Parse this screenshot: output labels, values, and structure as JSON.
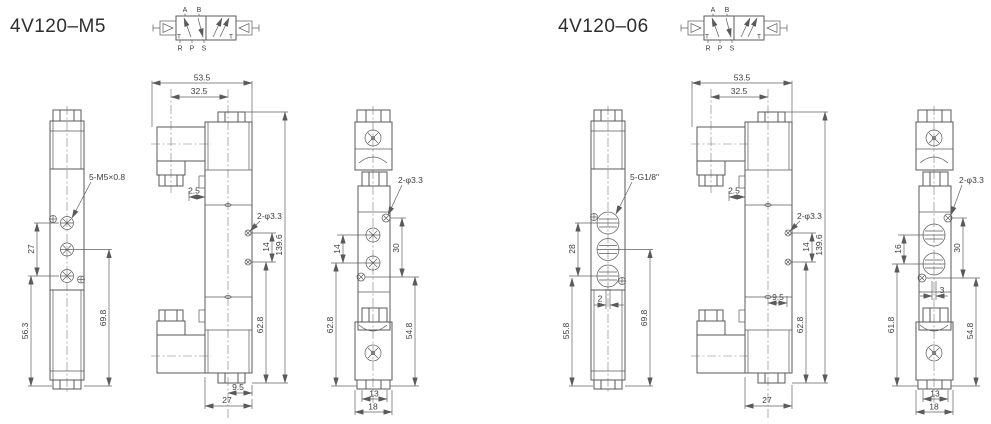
{
  "colors": {
    "line": "#5a5a5a",
    "dim_text": "#3d3d3d",
    "title": "#2e2e2e",
    "background": "#ffffff"
  },
  "left": {
    "title": "4V120–M5",
    "schematic": {
      "a": "A",
      "b": "B",
      "r": "R",
      "p": "P",
      "s": "S",
      "tl": "T",
      "tr": "T"
    },
    "side": {
      "thread": "5-M5×0.8",
      "spacing": "27",
      "lower": "56.3",
      "right": "69.8"
    },
    "front": {
      "width": "53.5",
      "width2": "32.5",
      "offset": "2.5",
      "holes": "2-φ3.3",
      "holespacing": "14",
      "height": "139.6",
      "height2": "62.8",
      "bottom1": "9.5",
      "bottom2": "27"
    },
    "end": {
      "holes": "2-φ3.3",
      "portspacing": "14",
      "upper": "30",
      "left": "62.8",
      "right": "54.8",
      "bottom1": "13",
      "bottom2": "18"
    }
  },
  "right": {
    "title": "4V120–06",
    "schematic": {
      "a": "A",
      "b": "B",
      "r": "R",
      "p": "P",
      "s": "S",
      "tl": "T",
      "tr": "T"
    },
    "side": {
      "thread": "5-G1/8\"",
      "spacing": "28",
      "offset": "2",
      "lower": "55.8",
      "right": "69.8"
    },
    "front": {
      "width": "53.5",
      "width2": "32.5",
      "offset": "2.5",
      "holes": "2-φ3.3",
      "holespacing": "14",
      "height": "139.6",
      "mid": "9.5",
      "height2": "62.8",
      "bottom2": "27"
    },
    "end": {
      "holes": "2-φ3.3",
      "portspacing": "16",
      "upper": "30",
      "left": "61.8",
      "right": "54.8",
      "offset": "3",
      "bottom1": "13",
      "bottom2": "18"
    }
  }
}
